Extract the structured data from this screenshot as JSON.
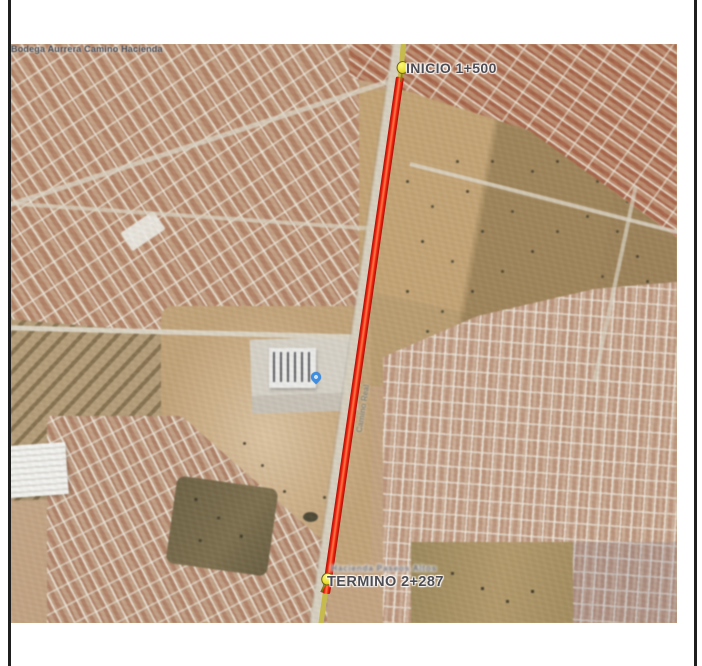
{
  "document": {
    "background": "#ffffff",
    "border_color": "#1f1f1f"
  },
  "map": {
    "type": "satellite-aerial",
    "route": {
      "start_label": "INICIO 1+500",
      "end_label": "TERMINO 2+287",
      "line_color": "#e2190b",
      "marker_color": "#efe83a",
      "road_highlight_color": "#c6ba4c"
    },
    "place_label": "Bodega Aurrera Camino Hacienda",
    "place_pin_color": "#3d8de0",
    "road_label_blurred": "Camino Real",
    "small_label_blurred": "Hacienda Paseos Altos",
    "label_text_color": "#4c4c52"
  }
}
